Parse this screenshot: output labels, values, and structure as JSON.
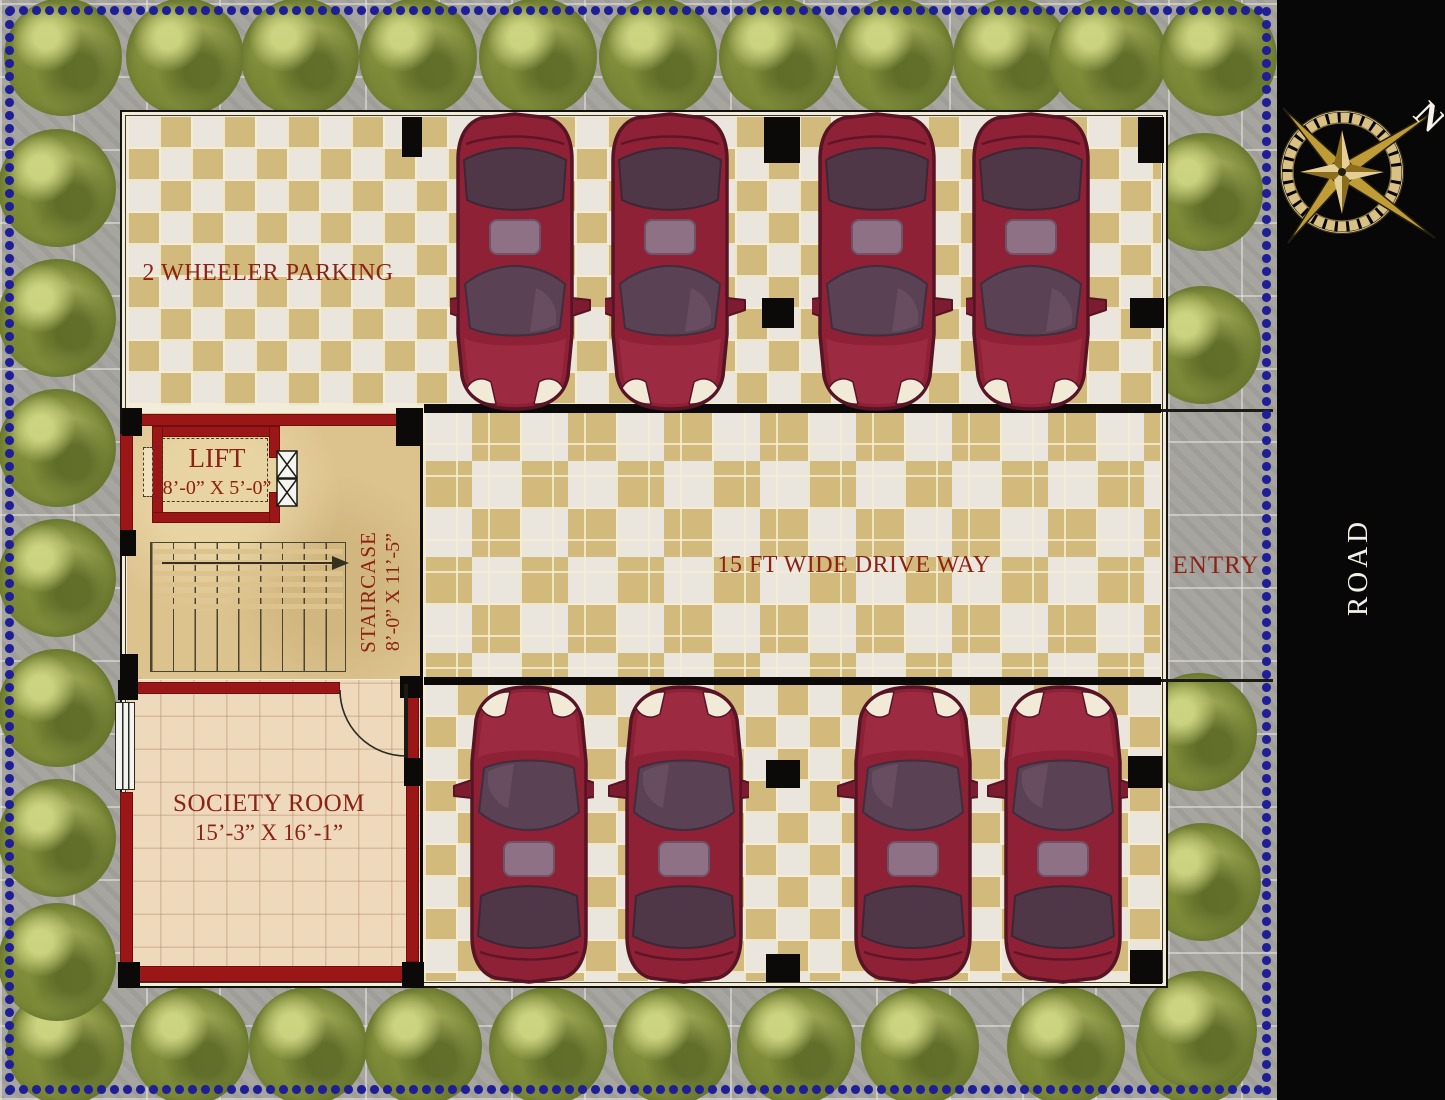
{
  "palette": {
    "wall_red": "#9a1617",
    "label_red": "#8c2213",
    "tile_tan": "#d2b97c",
    "tile_white": "#eae6dd",
    "society_floor_beige": "#eed9bd",
    "lobby_floor_sand": "#dcc28d",
    "pavement_gray": "#a7a5a0",
    "road_black": "#070707",
    "boundary_dot_blue": "#1e1e96",
    "tree_green": "#7f8c3b",
    "car_maroon": "#8e2135",
    "compass_gold": "#c9a843"
  },
  "rooms": {
    "two_wheeler_parking": {
      "label": "2 WHEELER PARKING"
    },
    "lift": {
      "label": "LIFT",
      "dimensions": "8’-0” X 5’-0”"
    },
    "staircase": {
      "label": "STAIRCASE",
      "dimensions": "8’-0” X 11’-5”"
    },
    "driveway": {
      "label": "15 FT WIDE DRIVE WAY"
    },
    "society_room": {
      "label": "SOCIETY ROOM",
      "dimensions": "15’-3” X 16’-1”"
    }
  },
  "site": {
    "entry_label": "ENTRY",
    "road_label": "ROAD",
    "compass_north_label": "N",
    "parked_cars": 8,
    "trees": 33
  }
}
